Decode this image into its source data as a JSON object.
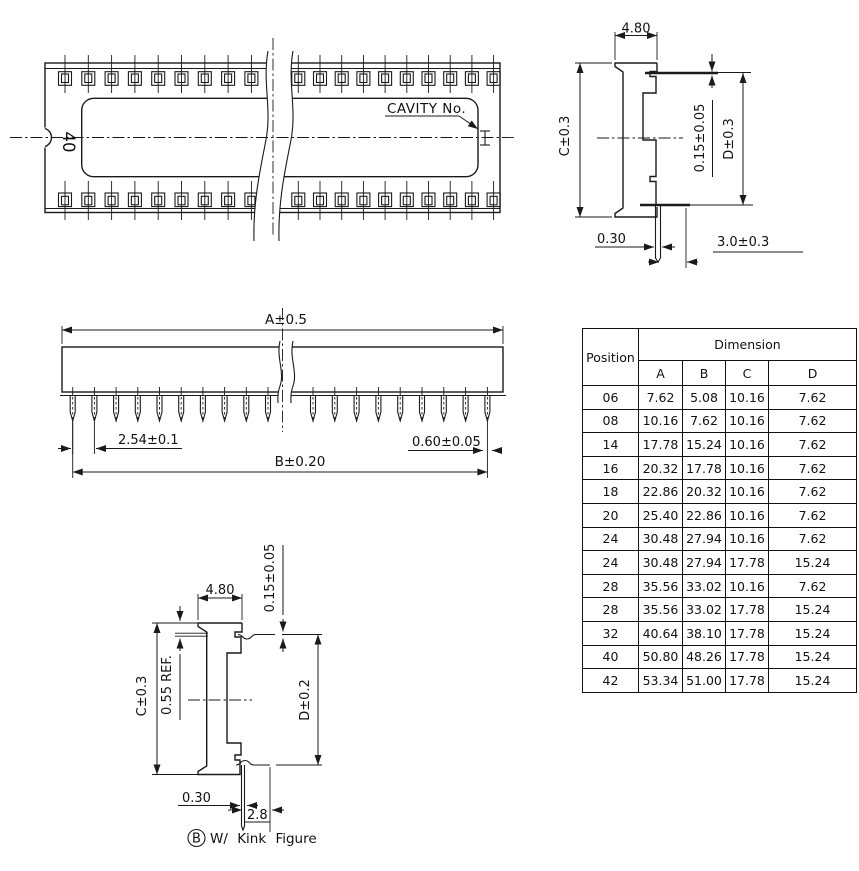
{
  "top_view": {
    "pin_count": "40",
    "cavity_label": "CAVITY No."
  },
  "end_view": {
    "dim_width": "4.80",
    "dim_height": "C±0.3",
    "dim_standoff": "0.15±0.05",
    "dim_seating": "D±0.3",
    "dim_lead_thickness": "0.30",
    "dim_tail_length": "3.0±0.3"
  },
  "pitch_view": {
    "dim_a": "A±0.5",
    "dim_pitch": "2.54±0.1",
    "dim_b": "B±0.20",
    "dim_lead_width": "0.60±0.05"
  },
  "kink_view": {
    "dim_width": "4.80",
    "dim_standoff": "0.15±0.05",
    "dim_height": "C±0.3",
    "dim_lip": "0.55 REF.",
    "dim_seating": "D±0.2",
    "dim_lead_thickness": "0.30",
    "dim_kink_length": "2.8",
    "caption_marker": "B",
    "caption_text": "W/ Kink Figure"
  },
  "table": {
    "header_position": "Position",
    "header_dimension": "Dimension",
    "columns": [
      "A",
      "B",
      "C",
      "D"
    ],
    "rows": [
      {
        "position": "06",
        "a": "7.62",
        "b": "5.08",
        "c": "10.16",
        "d": "7.62"
      },
      {
        "position": "08",
        "a": "10.16",
        "b": "7.62",
        "c": "10.16",
        "d": "7.62"
      },
      {
        "position": "14",
        "a": "17.78",
        "b": "15.24",
        "c": "10.16",
        "d": "7.62"
      },
      {
        "position": "16",
        "a": "20.32",
        "b": "17.78",
        "c": "10.16",
        "d": "7.62"
      },
      {
        "position": "18",
        "a": "22.86",
        "b": "20.32",
        "c": "10.16",
        "d": "7.62"
      },
      {
        "position": "20",
        "a": "25.40",
        "b": "22.86",
        "c": "10.16",
        "d": "7.62"
      },
      {
        "position": "24",
        "a": "30.48",
        "b": "27.94",
        "c": "10.16",
        "d": "7.62"
      },
      {
        "position": "24",
        "a": "30.48",
        "b": "27.94",
        "c": "17.78",
        "d": "15.24"
      },
      {
        "position": "28",
        "a": "35.56",
        "b": "33.02",
        "c": "10.16",
        "d": "7.62"
      },
      {
        "position": "28",
        "a": "35.56",
        "b": "33.02",
        "c": "17.78",
        "d": "15.24"
      },
      {
        "position": "32",
        "a": "40.64",
        "b": "38.10",
        "c": "17.78",
        "d": "15.24"
      },
      {
        "position": "40",
        "a": "50.80",
        "b": "48.26",
        "c": "17.78",
        "d": "15.24"
      },
      {
        "position": "42",
        "a": "53.34",
        "b": "51.00",
        "c": "17.78",
        "d": "15.24"
      }
    ]
  }
}
